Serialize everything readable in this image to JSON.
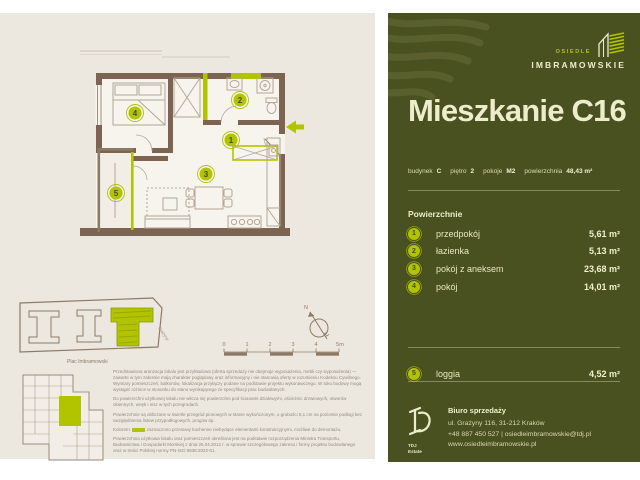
{
  "brand": {
    "osiedle": "OSIEDLE",
    "imbramowskie": "IMBRAMOWSKIE"
  },
  "title": "Mieszkanie C16",
  "details": [
    {
      "label": "budynek",
      "value": "C"
    },
    {
      "label": "piętro",
      "value": "2"
    },
    {
      "label": "pokoje",
      "value": "M2"
    },
    {
      "label": "powierzchnia",
      "value": "48,43 m²"
    }
  ],
  "areas": {
    "header": "Powierzchnie",
    "rooms": [
      {
        "num": "1",
        "name": "przedpokój",
        "area": "5,61 m²"
      },
      {
        "num": "2",
        "name": "łazienka",
        "area": "5,13 m²"
      },
      {
        "num": "3",
        "name": "pokój z aneksem",
        "area": "23,68 m²"
      },
      {
        "num": "4",
        "name": "pokój",
        "area": "14,01 m²"
      }
    ],
    "loggia": {
      "num": "5",
      "name": "loggia",
      "area": "4,52 m²"
    }
  },
  "contact": {
    "logo_top": "TDJ",
    "logo_bottom": "Estate",
    "office": "Biuro sprzedaży",
    "address": "ul. Grażyny 116, 31-212 Kraków",
    "phone_email": "+48 887 450 527 | osiedleimbramowskie@tdj.pl",
    "website": "www.osiedleimbramowskie.pl"
  },
  "plan": {
    "numbers": [
      "1",
      "2",
      "3",
      "4",
      "5"
    ],
    "scale": [
      "0",
      "1",
      "2",
      "3",
      "4",
      "5m"
    ],
    "north": "N"
  },
  "siteplan": {
    "place": "Plac Imbramowski",
    "street": "Grażyny"
  },
  "disclaimer": {
    "p1": "Przedstawiona aranżacja lokalu jest przykładowa (oferta sprzedaży nie obejmuje wyposażenia, mebli czy wyposażenia) — zawarte w tym zakresie mają charakter poglądowy oraz informacyjny i nie stanowią oferty w rozumieniu Kodeksu Cywilnego. Wymiary pomieszczeń, balkonów, lokalizacja przyłączy podane na podstawie projektu wykonawczego. W toku budowy mogą wystąpić różnice w stosunku do stanu wynikającego ze specyfikacji prac budowlanych.",
    "p2": "Do powierzchni użytkowej lokalu nie wlicza się powierzchni pod ścianami działowymi, ościeżnic drzwiowych, otworów okiennych, wnęk i nisz w tych przegrodach.",
    "p3": "Powierzchnie są obliczane w świetle przegród pionowych w stanie wykończonym, o grubości 5,1 cm na poziomie podłogi bez uwzględnienia listew przypodłogowych, progów itp.",
    "p4a": "Kolorem",
    "p4b": "zaznaczono przesuwy kuchenne niebędące elementami konstrukcyjnymi, możliwe do demontażu.",
    "p5": "Powierzchnia użytkowa lokalu oraz pomieszczeń określona jest na podstawie rozporządzenia Ministra Transportu, Budownictwa i Gospodarki Morskiej z dnia 25.04.2012 r. w sprawie szczegółowego zakresu i formy projektu budowlanego oraz w treści Polskiej normy PN-ISO 9836:2022-01."
  },
  "colors": {
    "accent": "#b2c400",
    "panel": "#4a5120",
    "cream": "#edeccb",
    "beige": "#ece8e0"
  }
}
